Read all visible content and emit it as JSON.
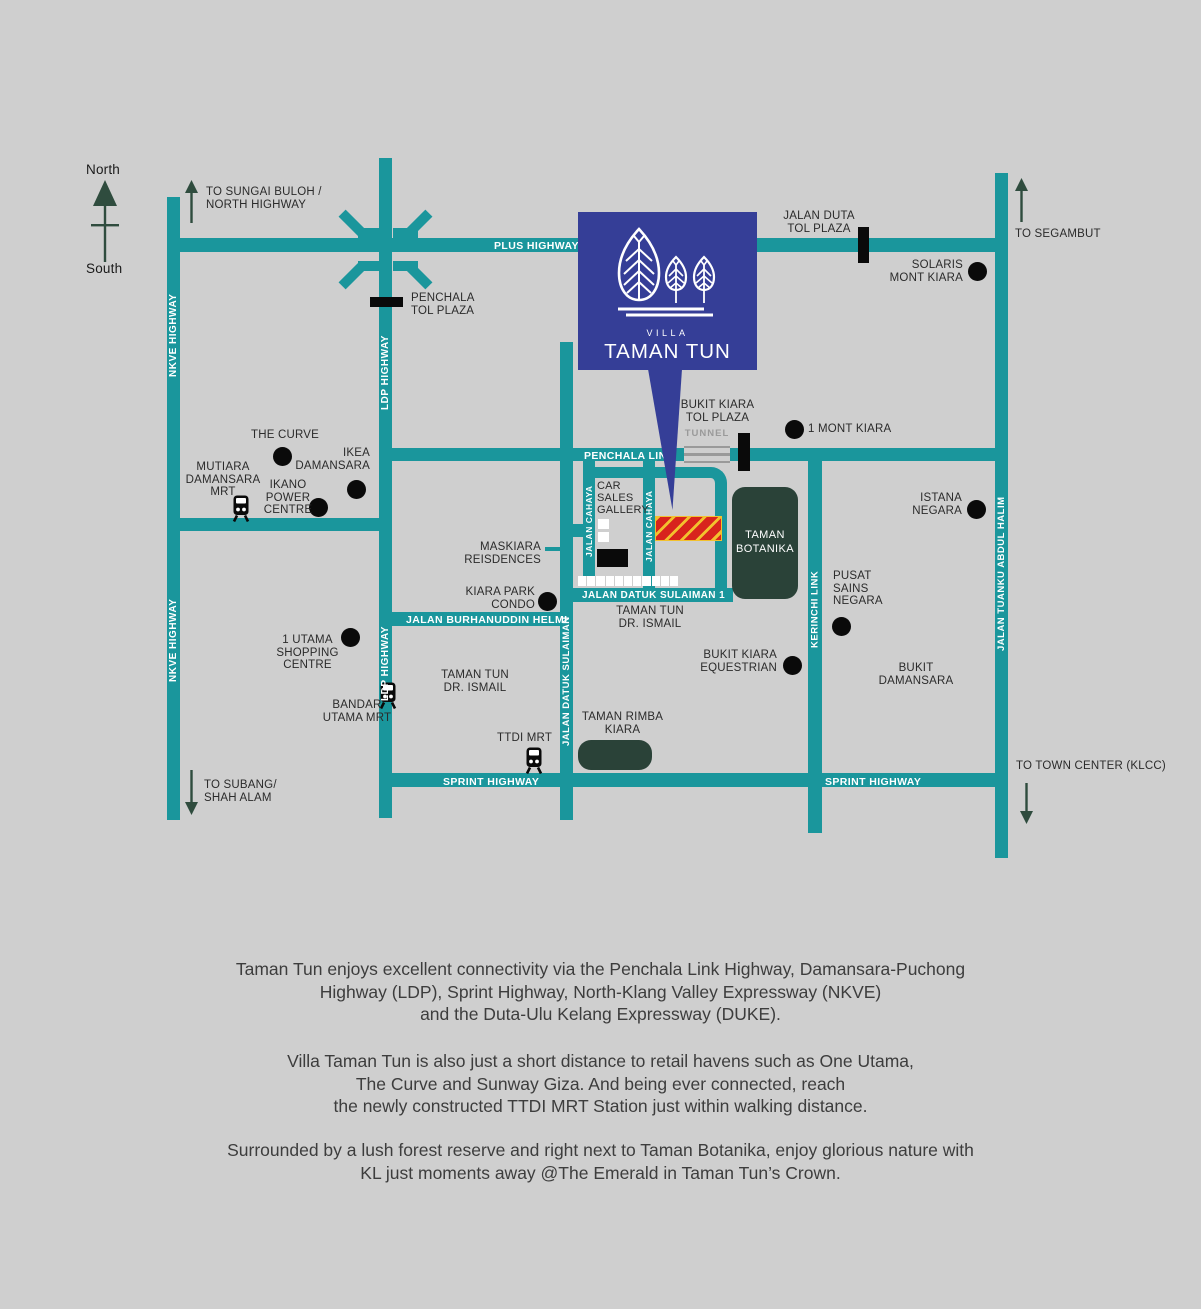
{
  "colors": {
    "background": "#cfcfcf",
    "road_teal": "#1A969C",
    "villa_blue": "#353E97",
    "forest_green": "#2A4238",
    "arrow_green": "#2F4C3E",
    "site_red": "#D8231D",
    "site_yellow": "#F2C12E",
    "marker_black": "#0A0A0A",
    "tunnel_gray": "#9A9A9A"
  },
  "compass": {
    "north": "North",
    "south": "South"
  },
  "logo": {
    "villa": "VILLA",
    "name": "TAMAN TUN"
  },
  "roads": {
    "plus_highway": "PLUS HIGHWAY",
    "penchala_link": "PENCHALA LINK",
    "sprint_highway_left": "SPRINT HIGHWAY",
    "sprint_highway_right": "SPRINT HIGHWAY",
    "jalan_burhanuddin_helmi": "JALAN BURHANUDDIN HELMI",
    "jalan_datuk_sulaiman_1": "JALAN DATUK SULAIMAN 1",
    "nkve_top": "NKVE HIGHWAY",
    "nkve_bottom": "NKVE HIGHWAY",
    "ldp_top": "LDP HIGHWAY",
    "ldp_bottom": "LDP HIGHWAY",
    "jalan_cahaya_left": "JALAN CAHAYA",
    "jalan_cahaya_right": "JALAN CAHAYA",
    "jalan_datuk_sulaiman": "JALAN DATUK SULAIMAN",
    "kerinchi_link": "KERINCHI LINK",
    "jalan_tuanku_abdul_halim": "JALAN TUANKU ABDUL HALIM"
  },
  "tolls": {
    "penchala": "PENCHALA\nTOL PLAZA",
    "jalan_duta": "JALAN DUTA\nTOL PLAZA",
    "bukit_kiara": "BUKIT KIARA\nTOL PLAZA",
    "tunnel": "TUNNEL"
  },
  "directions": {
    "sungai_buloh": "TO SUNGAI BULOH /\nNORTH HIGHWAY",
    "segambut": "TO SEGAMBUT",
    "subang": "TO SUBANG/\nSHAH ALAM",
    "town_center": "TO TOWN CENTER (KLCC)"
  },
  "pois": {
    "the_curve": "THE CURVE",
    "ikea_damansara": "IKEA\nDAMANSARA",
    "mutiara_damansara_mrt": "MUTIARA\nDAMANSARA\nMRT",
    "ikano_power_centre": "IKANO\nPOWER\nCENTRE",
    "solaris_mont_kiara": "SOLARIS\nMONT KIARA",
    "one_mont_kiara": "1 MONT KIARA",
    "istana_negara": "ISTANA\nNEGARA",
    "pusat_sains_negara": "PUSAT\nSAINS\nNEGARA",
    "bukit_damansara": "BUKIT\nDAMANSARA",
    "bukit_kiara_equestrian": "BUKIT KIARA\nEQUESTRIAN",
    "kiara_park_condo": "KIARA PARK\nCONDO",
    "maskiara_residences": "MASKIARA\nREISDENCES",
    "car_sales_gallery": "CAR\nSALES\nGALLERY",
    "taman_botanika": "TAMAN\nBOTANIKA",
    "taman_tun_dr_ismail_east": "TAMAN TUN\nDR. ISMAIL",
    "taman_tun_dr_ismail_west": "TAMAN TUN\nDR. ISMAIL",
    "taman_rimba_kiara": "TAMAN RIMBA\nKIARA",
    "ttdi_mrt": "TTDI MRT",
    "one_utama": "1 UTAMA\nSHOPPING CENTRE",
    "bandar_utama_mrt": "BANDAR\nUTAMA MRT"
  },
  "description": {
    "p1": "Taman Tun enjoys excellent connectivity via the Penchala Link Highway, Damansara-Puchong\nHighway (LDP), Sprint Highway, North-Klang Valley Expressway (NKVE)\nand the Duta-Ulu Kelang Expressway (DUKE).",
    "p2": "Villa Taman Tun is also just a short distance to retail havens such as One Utama,\nThe Curve and Sunway Giza. And being ever connected, reach\nthe newly constructed TTDI MRT Station just within walking distance.",
    "p3": "Surrounded by a lush forest reserve and right next to Taman Botanika, enjoy glorious nature with\nKL just moments away @The Emerald in Taman Tun’s Crown."
  }
}
